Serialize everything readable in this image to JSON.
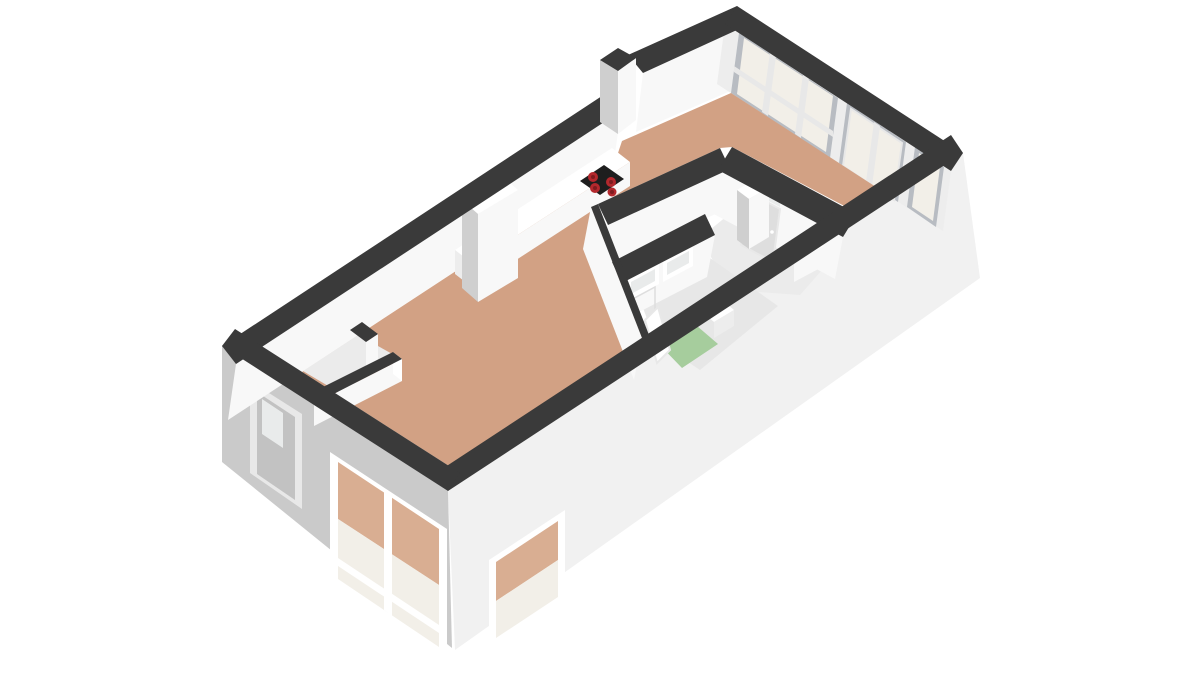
{
  "scene": {
    "kind": "3d-floorplan-render",
    "view": "isometric-top-down",
    "description": "3D rendered floor plan of a small apartment viewed from above at an angle",
    "visible_text": "none"
  },
  "colors": {
    "bg": "#ffffff",
    "wallTop": "#3a3a3a",
    "extLeft": "#cacaca",
    "extSE": "#f1f1f1",
    "innerFace": "#f8f8f8",
    "innerFaceShade": "#ededed",
    "floorTan": "#d2a184",
    "floorWhite": "#ebebeb",
    "floorBath": "#e7e7e7",
    "shower": "#a6cd9d",
    "frameGray": "#b8bcc2",
    "frameLight": "#e8e8e8",
    "glassWarm": "#f2efe8",
    "glassCool": "#e9ebeb",
    "glassTan": "#d9ae92",
    "pureWhite": "#ffffff",
    "cooktop": "#1e1e1e",
    "burnerOuter": "#b3282d",
    "burnerInner": "#7e1b1f",
    "doorPanel": "#dedede",
    "extDoorPanel": "#c2c2c2",
    "pillarSide": "#cfcfcf"
  },
  "rooms": [
    {
      "name": "open-living-area",
      "floor": "tan wood"
    },
    {
      "name": "kitchen-zone",
      "floor": "tan wood",
      "features": [
        "counter",
        "tall cabinet",
        "cooktop with 4 burners"
      ]
    },
    {
      "name": "upper-room-with-windows",
      "floor": "tan wood",
      "features": [
        "large 3-pane window",
        "french-doors",
        "side window pane"
      ]
    },
    {
      "name": "hall",
      "floor": "light gray",
      "features": [
        "interior door with transom",
        "low cabinet",
        "duct column"
      ]
    },
    {
      "name": "bathroom",
      "floor": "light gray",
      "features": [
        "green shower floor",
        "washbasin",
        "open door"
      ]
    },
    {
      "name": "toilet-room",
      "floor": "light gray",
      "features": [
        "transom windows above doors"
      ]
    },
    {
      "name": "storage-closet",
      "floor": "light gray",
      "features": [
        "partition walls",
        "exterior door"
      ]
    }
  ],
  "fixtures": {
    "cooktop_burner_count": 4,
    "exterior_openings": [
      "left exterior door",
      "large bottom-left window",
      "corner window"
    ],
    "interior_openings": [
      "two transom windows",
      "front-style interior door",
      "open bathroom door"
    ]
  }
}
